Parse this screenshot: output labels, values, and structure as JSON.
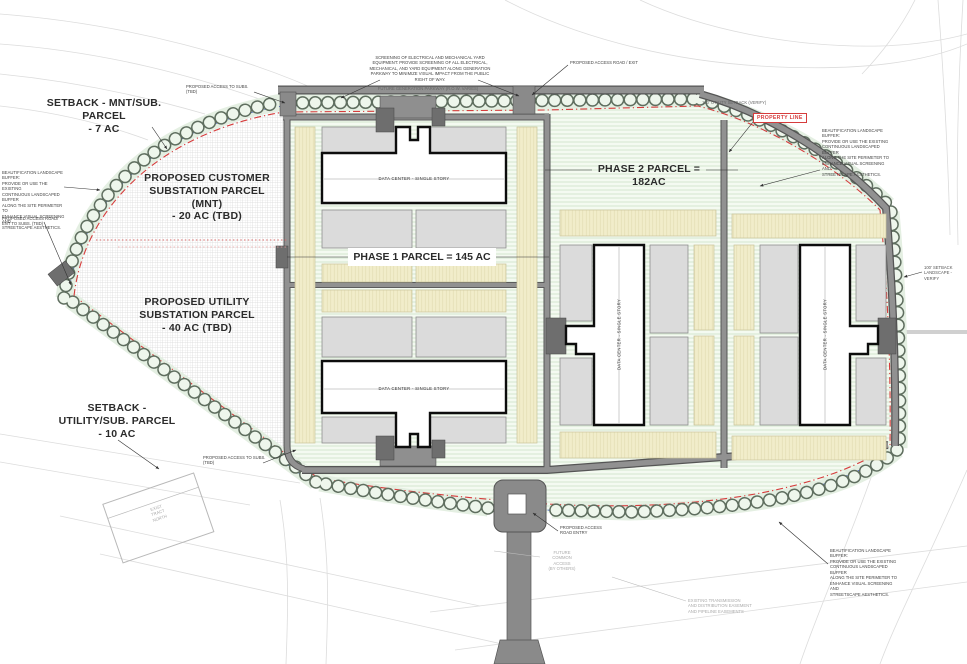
{
  "drawing": {
    "parcels": {
      "setback_mnt_sub": "SETBACK - MNT/SUB.\nPARCEL\n- 7 AC",
      "customer_substation": "PROPOSED CUSTOMER\nSUBSTATION PARCEL\n(MNT)\n- 20 AC (TBD)",
      "utility_substation": "PROPOSED UTILITY\nSUBSTATION PARCEL\n- 40 AC (TBD)",
      "setback_utility_sub": "SETBACK -\nUTILITY/SUB. PARCEL\n- 10 AC",
      "phase1": "PHASE 1  PARCEL = 145 AC",
      "phase2": "PHASE 2  PARCEL =\n182AC"
    },
    "buildings": {
      "data_center": "DATA CENTER - SINGLE STORY"
    },
    "callouts": {
      "property_line": "PROPERTY LINE",
      "beautification_buffer": "BEAUTIFICATION LANDSCAPE BUFFER:\nPROVIDE OR USE THE EXISTING\nCONTINUOUS LANDSCAPED BUFFER\nALONG THE SITE PERIMETER TO\nENHANCE VISUAL SCREENING AND\nSTREETSCAPE AESTHETICS.",
      "screening_note": "SCREENING OF ELECTRICAL AND MECHANICAL YARD\nEQUIPMENT: PROVIDE SCREENING OF ALL ELECTRICAL,\nMECHANICAL, AND YARD EQUIPMENT ALONG GENERATION\nPARKWAY TO MINIMIZE VISUAL IMPACT FROM THE PUBLIC\nRIGHT OF WAY.",
      "future_generation_parkway": "FUTURE GENERATION PARKWAY (R.O.W. VARIES)",
      "access_road_exit": "PROPOSED ACCESS ROAD / EXIT",
      "access_to_subs": "PROPOSED ACCESS TO SUBS.\n(TBD)",
      "access_road_ent_to_subs": "PROPOSED ACCESS ROAD/\nENT TO SUBS. (TBD)",
      "utility_setback_100": "100' UTILITY SETBACK (VERIFY)",
      "setback_landscape_100": "100' SETBACK\nLANDSCAPE - VERIFY",
      "access_road_entry": "PROPOSED ACCESS\nROAD ENTRY",
      "future_common_access": "FUTURE\nCOMMON\nACCESS\n(BY OTHERS)",
      "existing_easement": "EXISTING TRANSMISSION\nAND DISTRIBUTION EASEMENT\nAND PIPELINE EASEMENTS",
      "exist_tract": "EXIST\nTRACT\nNORTH"
    },
    "colors": {
      "property_line_red": "#d63c3c",
      "setback_blue": "#4a63c8",
      "buffer_green": "#e3efe1",
      "parcel_cream": "#f0ecc9",
      "pad_gray": "#dbdbdb",
      "road_gray": "#909090"
    }
  }
}
